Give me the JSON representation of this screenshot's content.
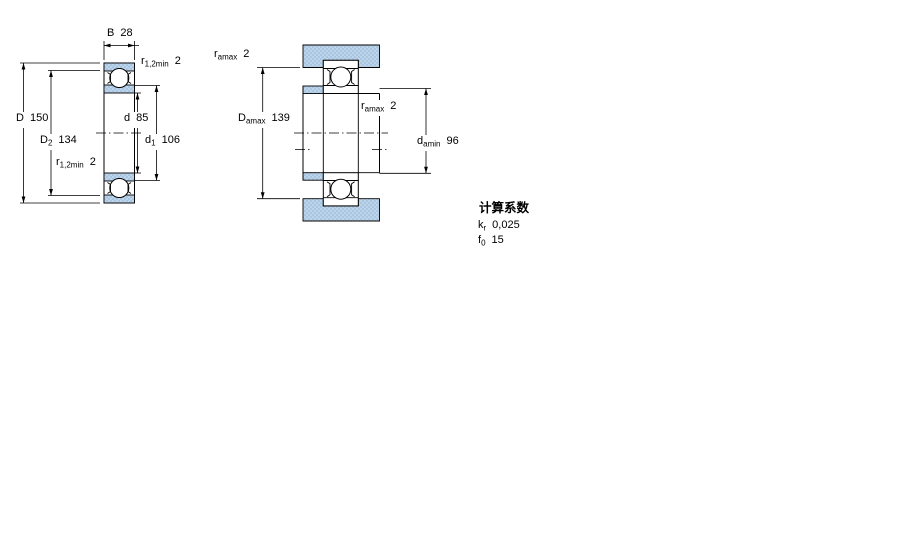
{
  "drawing": {
    "left_figure": {
      "description": "bearing-cross-section",
      "labels": {
        "B": {
          "sym": "B",
          "sub": "",
          "val": "28"
        },
        "r_top": {
          "sym": "r",
          "sub": "1,2min",
          "val": "2"
        },
        "D": {
          "sym": "D",
          "sub": "",
          "val": "150"
        },
        "D2": {
          "sym": "D",
          "sub": "2",
          "val": "134"
        },
        "r_bottom": {
          "sym": "r",
          "sub": "1,2min",
          "val": "2"
        },
        "d": {
          "sym": "d",
          "sub": "",
          "val": "85"
        },
        "d1": {
          "sym": "d",
          "sub": "1",
          "val": "106"
        }
      }
    },
    "right_figure": {
      "description": "abutment-mounted-section",
      "labels": {
        "r_top": {
          "sym": "r",
          "sub": "amax",
          "val": "2"
        },
        "Damax": {
          "sym": "D",
          "sub": "amax",
          "val": "139"
        },
        "r_mid": {
          "sym": "r",
          "sub": "amax",
          "val": "2"
        },
        "damin": {
          "sym": "d",
          "sub": "amin",
          "val": "96"
        }
      }
    },
    "calculation_factors": {
      "title": "计算系数",
      "kr": {
        "sym": "k",
        "sub": "r",
        "val": "0,025"
      },
      "f0": {
        "sym": "f",
        "sub": "0",
        "val": "15"
      }
    },
    "colors": {
      "section_fill": "#a9c6e0",
      "section_fill_dot": "#bed4ea",
      "line": "#000000",
      "background": "#ffffff"
    }
  }
}
